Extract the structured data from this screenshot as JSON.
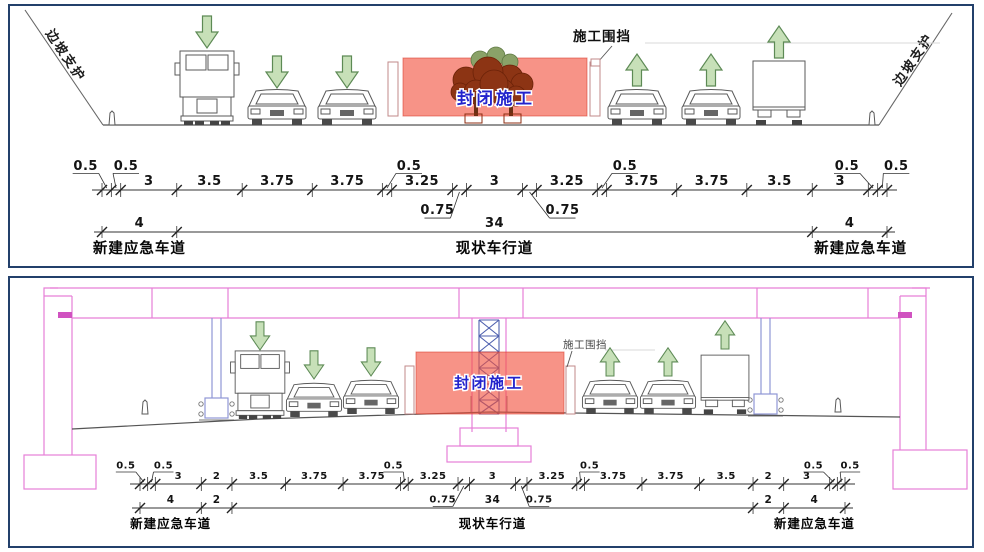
{
  "colors": {
    "panel_border": "#23406B",
    "closed_zone_fill": "#F0604F",
    "closed_zone_text_blue": "#2323CC",
    "traffic_arrow_green": "#C7E0B8",
    "bridge_outline_pink": "#E77FD7",
    "pier_outline_blue": "#8F97D6",
    "scaffold_blue": "#4D5FAE"
  },
  "icons": {
    "left_lanes_arrow": "green-down-arrow-icon",
    "right_lanes_arrow": "green-up-arrow-icon",
    "vehicle_icons": [
      "truck-front-icon",
      "car-front-icon",
      "truck-rear-icon"
    ],
    "tree_icon": "shrub-cluster-icon"
  },
  "diagram_top": {
    "slope_label_left": "边坡支护",
    "slope_label_right": "边坡支护",
    "fence_callout": "施工围挡",
    "closed_zone_label": "封闭施工",
    "dim_segments": [
      "0.5",
      "0.5",
      "3",
      "3.5",
      "3.75",
      "3.75",
      "0.5",
      "3.25",
      "0.75",
      "3",
      "0.75",
      "3.25",
      "0.5",
      "3.75",
      "3.75",
      "3.5",
      "3",
      "0.5",
      "0.5"
    ],
    "dim_totals": [
      "4",
      "34",
      "4"
    ],
    "lane_labels": [
      "新建应急车道",
      "现状车行道",
      "新建应急车道"
    ]
  },
  "diagram_bottom": {
    "fence_callout": "施工围挡",
    "closed_zone_label": "封闭施工",
    "dim_segments": [
      "0.5",
      "0.5",
      "3",
      "2",
      "3.5",
      "3.75",
      "3.75",
      "0.5",
      "3.25",
      "0.75",
      "3",
      "0.75",
      "3.25",
      "0.5",
      "3.75",
      "3.75",
      "3.5",
      "2",
      "3",
      "0.5",
      "0.5"
    ],
    "dim_totals": [
      "4",
      "2",
      "34",
      "2",
      "4"
    ],
    "lane_labels": [
      "新建应急车道",
      "现状车行道",
      "新建应急车道"
    ]
  }
}
